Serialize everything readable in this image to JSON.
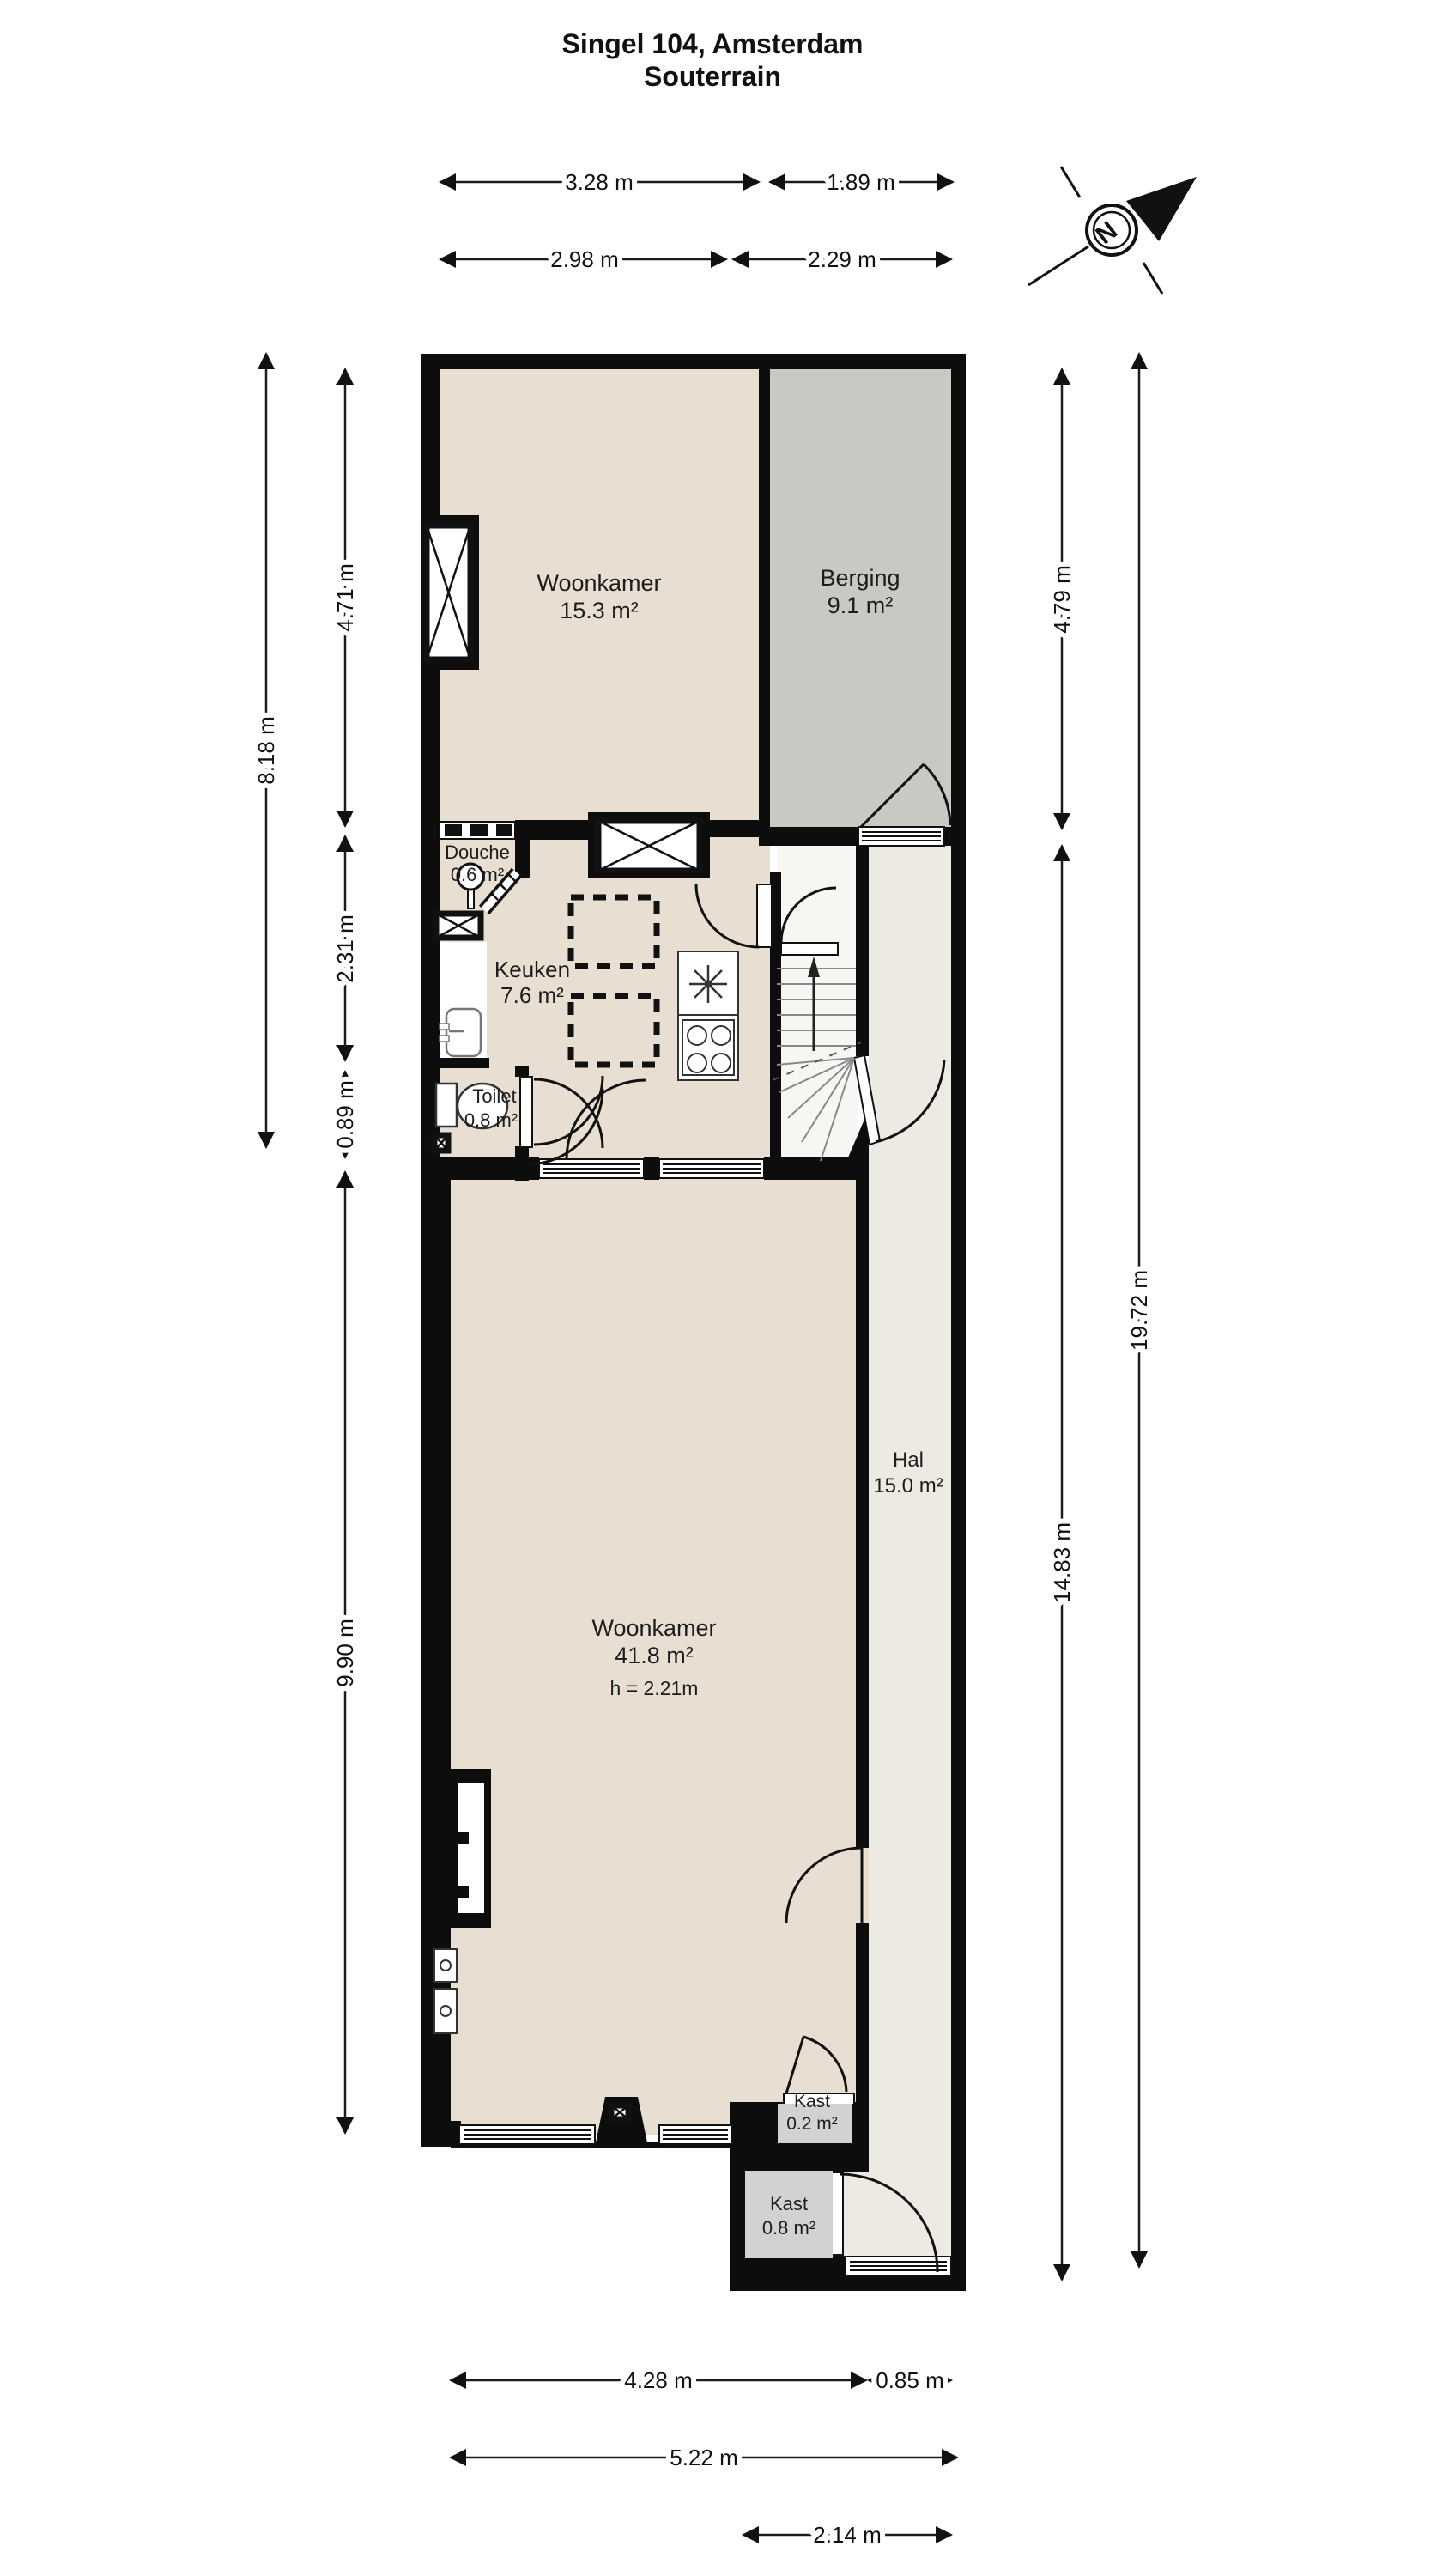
{
  "title": {
    "line1": "Singel 104, Amsterdam",
    "line2": "Souterrain"
  },
  "compass": {
    "label": "N"
  },
  "rooms": {
    "woonkamer_boven": {
      "name": "Woonkamer",
      "area": "15.3 m²"
    },
    "berging": {
      "name": "Berging",
      "area": "9.1 m²"
    },
    "douche": {
      "name": "Douche",
      "area": "0.6 m²"
    },
    "keuken": {
      "name": "Keuken",
      "area": "7.6 m²"
    },
    "toilet": {
      "name": "Toilet",
      "area": "0.8 m²"
    },
    "hal": {
      "name": "Hal",
      "area": "15.0 m²"
    },
    "woonkamer_onder": {
      "name": "Woonkamer",
      "area": "41.8 m²",
      "height_note": "h = 2.21m"
    },
    "kast_klein": {
      "name": "Kast",
      "area": "0.2 m²"
    },
    "kast_groot": {
      "name": "Kast",
      "area": "0.8 m²"
    }
  },
  "dims": {
    "t1": "3.28 m",
    "t2": "1.89 m",
    "t3": "2.98 m",
    "t4": "2.29 m",
    "l_outer": "8.18 m",
    "l1": "4.71 m",
    "l2": "2.31 m",
    "l3": "0.89 m",
    "l4": "9.90 m",
    "r1": "4.79 m",
    "r2": "14.83 m",
    "r_outer": "19.72 m",
    "b1": "4.28 m",
    "b2": "0.85 m",
    "b3": "5.22 m",
    "b4": "2.14 m"
  },
  "colors": {
    "wall": "#0d0d0d",
    "floor": "#e8dfd2",
    "berging": "#c6cac3",
    "hal": "#edeae4",
    "stairs": "#f7f6f3",
    "kast": "#d2d2d0",
    "ink": "#1a1a1a"
  }
}
